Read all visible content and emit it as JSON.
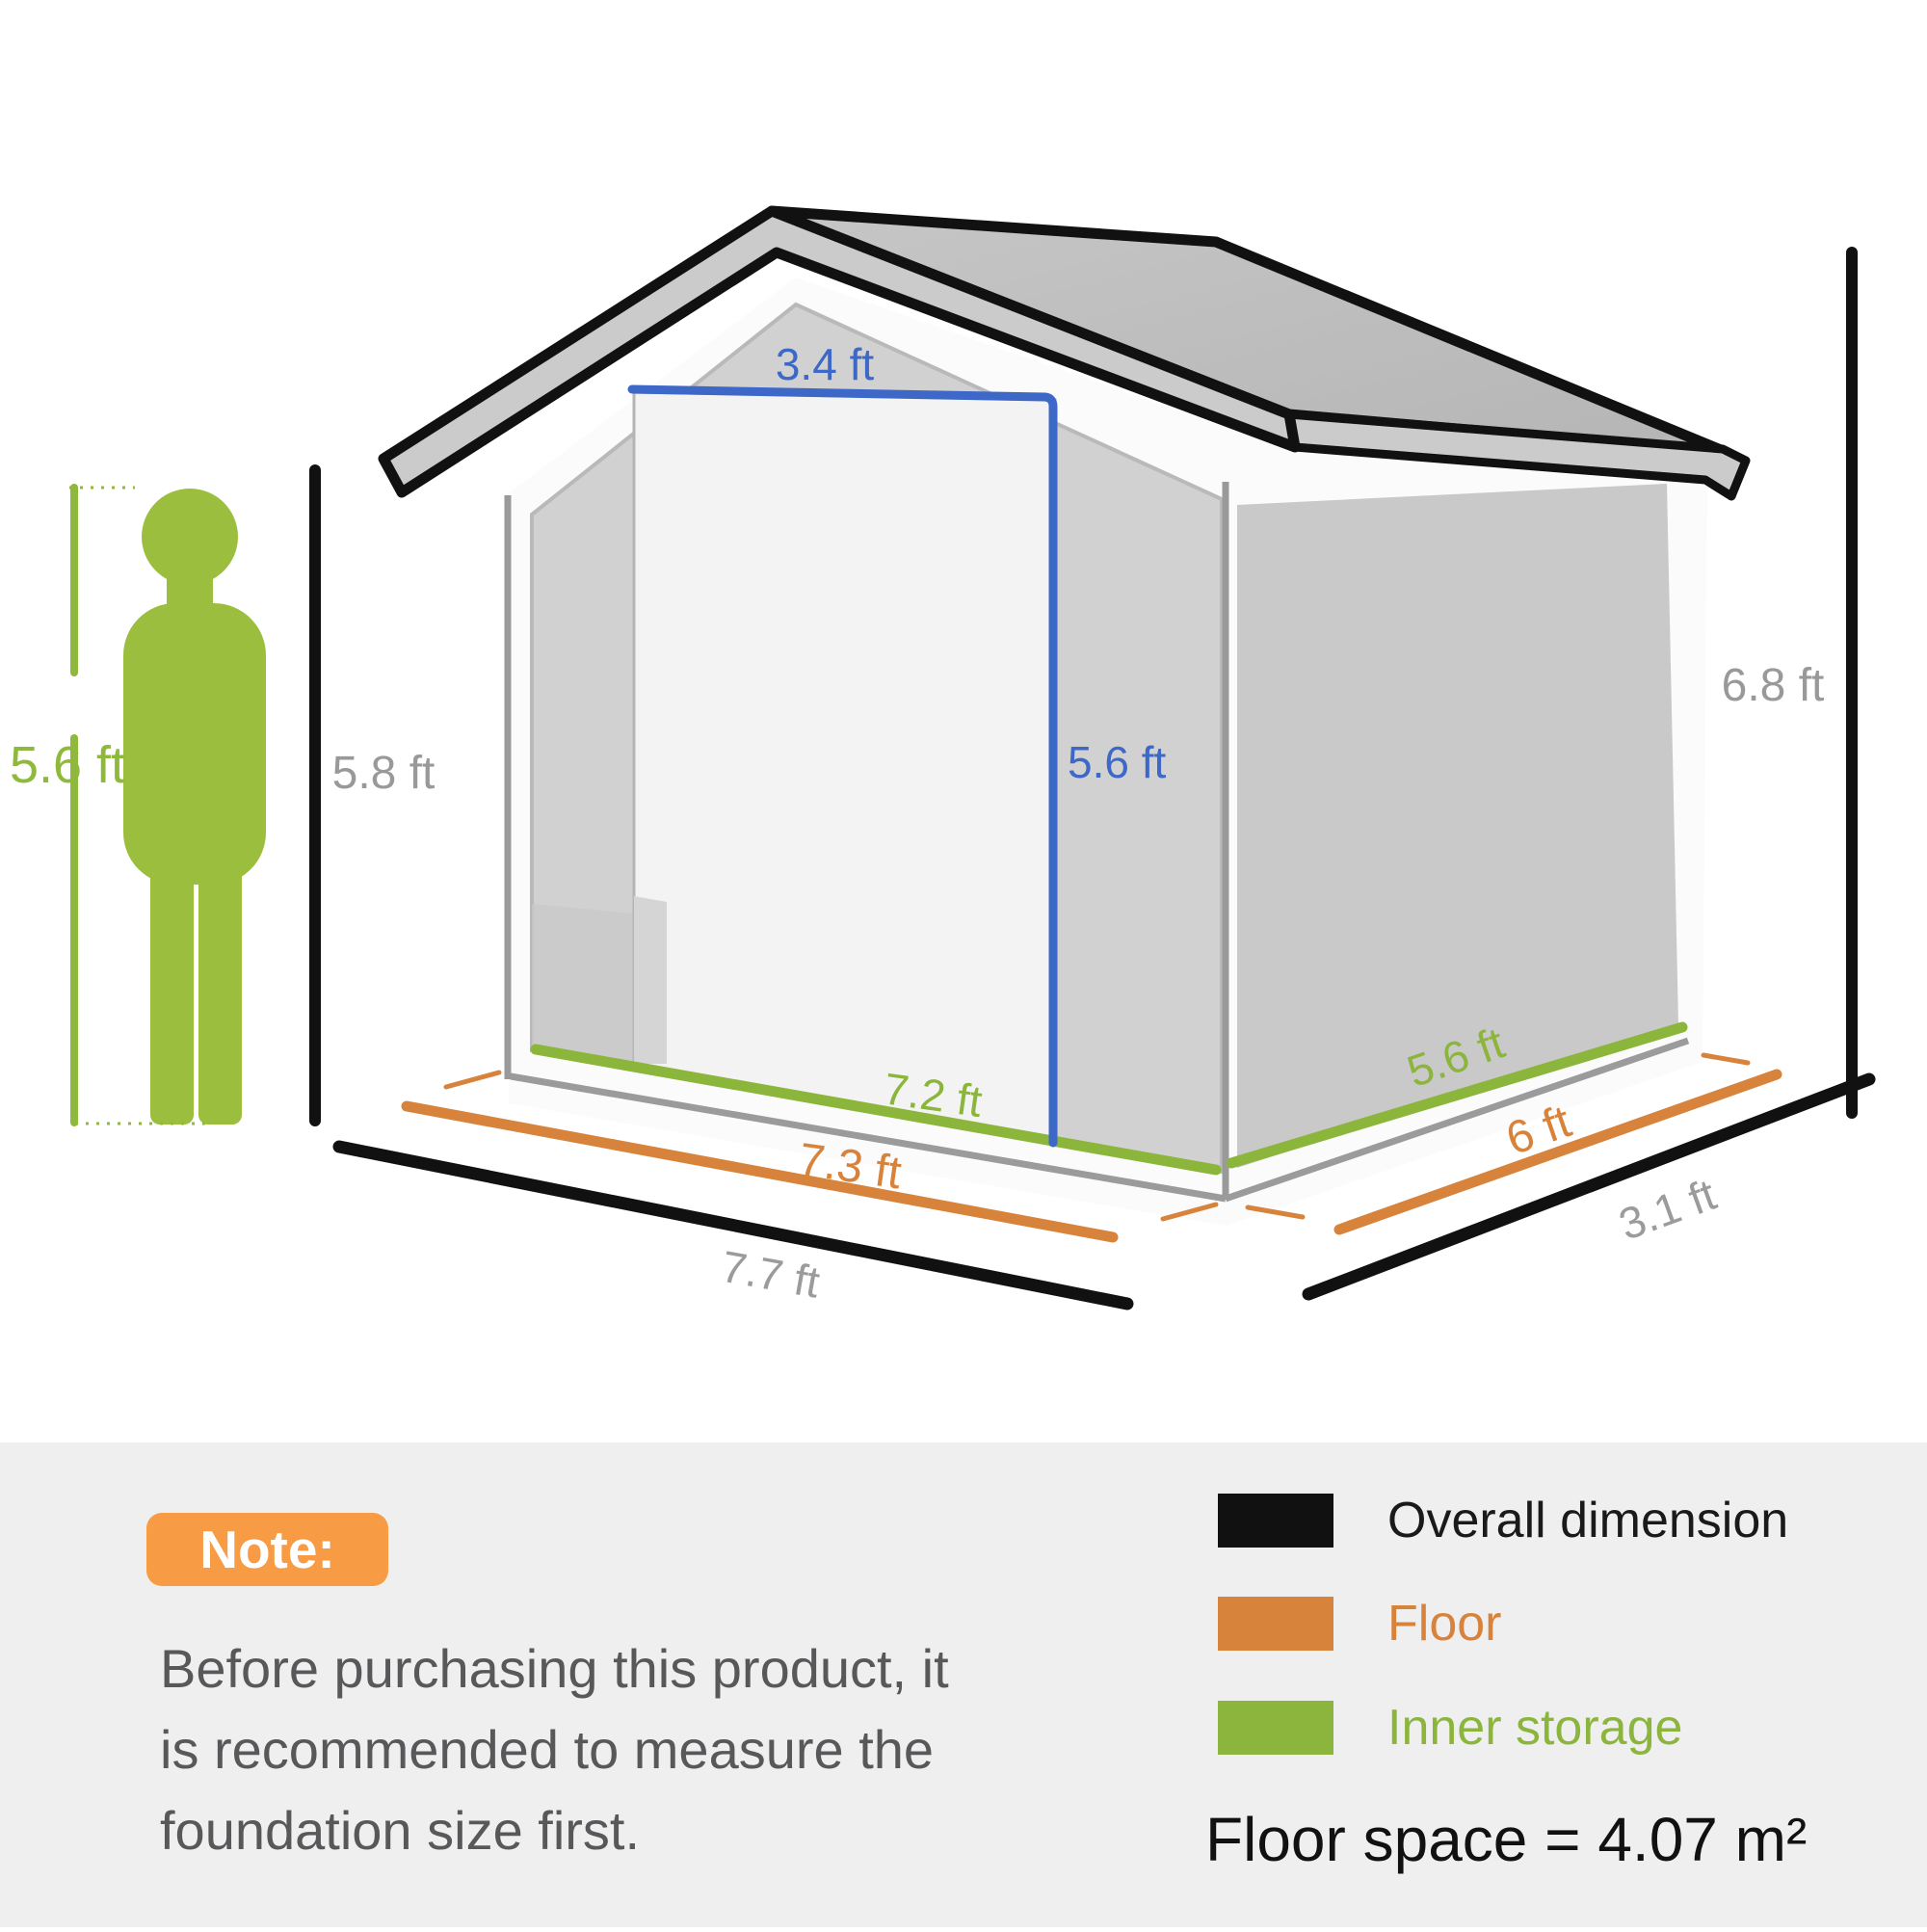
{
  "diagram": {
    "person": {
      "height_label": "5.6 ft"
    },
    "shed_labels": {
      "door_width": "3.4 ft",
      "door_height": "5.6 ft",
      "wall_height": "5.8 ft",
      "overall_height": "6.8 ft",
      "inner_width": "7.2 ft",
      "floor_width": "7.3 ft",
      "overall_width": "7.7 ft",
      "inner_depth": "5.6 ft",
      "floor_depth": "6 ft",
      "overall_depth": "3.1 ft"
    },
    "colors": {
      "overall_dimension": "#111111",
      "floor": "#D8833B",
      "inner_storage": "#8CB53C",
      "door_dimension": "#3E68C7",
      "gray_label": "#999999",
      "person_green": "#9CBE3F",
      "note_badge_orange": "#F79B45"
    }
  },
  "note": {
    "title": "Note:",
    "lines": [
      "Before purchasing this product, it",
      "is recommended to measure the",
      "foundation size first."
    ]
  },
  "legend": {
    "items": [
      {
        "label": "Overall dimension",
        "color": "#111111"
      },
      {
        "label": "Floor",
        "color": "#D8833B"
      },
      {
        "label": "Inner storage",
        "color": "#8CB53E"
      }
    ],
    "floor_space": "Floor space = 4.07 m²"
  }
}
